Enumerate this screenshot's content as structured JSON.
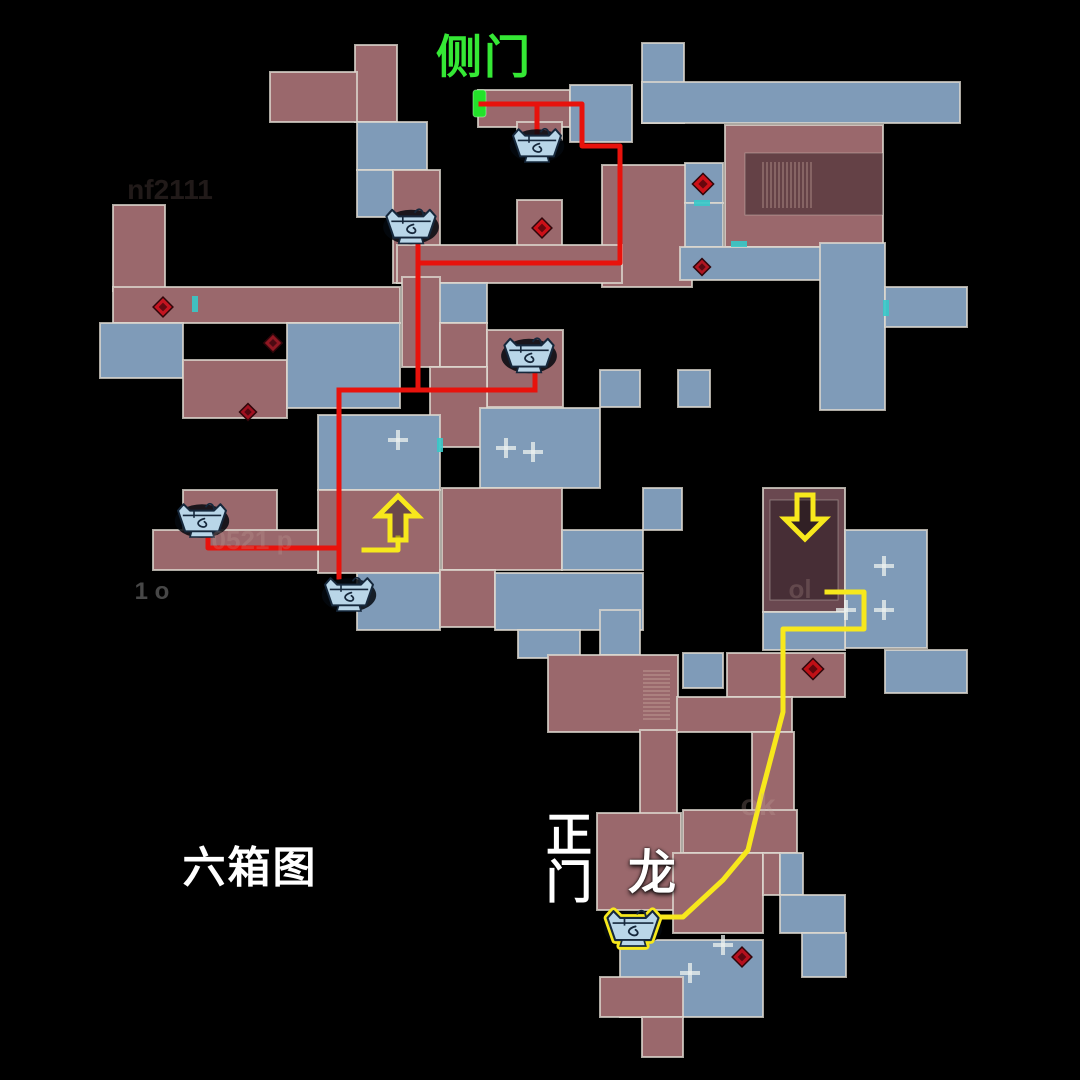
{
  "map": {
    "width": 1080,
    "height": 1080,
    "background": "#000000",
    "palette": {
      "red_room": "#9a686c",
      "blue_room": "#7f9bb8",
      "dark_red_room": "#6a4850",
      "inner_shade": "rgba(20,8,14,0.40)",
      "wall": "rgba(222,217,207,0.78)",
      "route_red": "#e8120c",
      "route_yellow": "#f7e81c",
      "marker_green": "#23e22a",
      "teal_door": "#37c9c9",
      "chest_body": "#b9d6e8",
      "chest_line": "#16283c",
      "chest_shadow": "rgba(4,8,14,0.85)",
      "stair_line": "rgba(222,194,178,0.55)",
      "plus_mark": "rgba(236,241,239,0.75)"
    },
    "labels": {
      "side_door": {
        "text": "侧门",
        "x": 484,
        "y": 57,
        "color": "#35e835",
        "size": 46
      },
      "six_box_map": {
        "text": "六箱图",
        "x": 250,
        "y": 869,
        "color": "#ffffff",
        "size": 43
      },
      "main_gate_top": {
        "text": "正",
        "x": 570,
        "y": 835,
        "color": "#ffffff",
        "size": 46
      },
      "main_gate_bottom": {
        "text": "门",
        "x": 570,
        "y": 882,
        "color": "#ffffff",
        "size": 46
      },
      "dragon": {
        "text": "龙",
        "x": 653,
        "y": 874,
        "color": "#ffffff",
        "size": 48
      }
    },
    "faint_texts": [
      {
        "text": "nf2111",
        "x": 170,
        "y": 190,
        "size": 28,
        "color": "#caa49c",
        "opacity": 0.16
      },
      {
        "text": "0521 p",
        "x": 252,
        "y": 540,
        "size": 26,
        "color": "#c8a8a0",
        "opacity": 0.22
      },
      {
        "text": "ok",
        "x": 758,
        "y": 806,
        "size": 30,
        "color": "#c8a8a0",
        "opacity": 0.25
      },
      {
        "text": "ol",
        "x": 800,
        "y": 589,
        "size": 26,
        "color": "#c8a8a0",
        "opacity": 0.22
      },
      {
        "text": "1 o",
        "x": 152,
        "y": 592,
        "size": 24,
        "color": "#cccccc",
        "opacity": 0.35
      }
    ],
    "rooms": [
      {
        "x": 355,
        "y": 45,
        "w": 42,
        "h": 77,
        "c": "r"
      },
      {
        "x": 270,
        "y": 72,
        "w": 87,
        "h": 50,
        "c": "r"
      },
      {
        "x": 357,
        "y": 122,
        "w": 70,
        "h": 48,
        "c": "b"
      },
      {
        "x": 357,
        "y": 170,
        "w": 36,
        "h": 47,
        "c": "b"
      },
      {
        "x": 393,
        "y": 170,
        "w": 47,
        "h": 113,
        "c": "r"
      },
      {
        "x": 478,
        "y": 90,
        "w": 92,
        "h": 37,
        "c": "r"
      },
      {
        "x": 570,
        "y": 85,
        "w": 62,
        "h": 57,
        "c": "b"
      },
      {
        "x": 517,
        "y": 122,
        "w": 45,
        "h": 18,
        "c": "r"
      },
      {
        "x": 517,
        "y": 200,
        "w": 45,
        "h": 50,
        "c": "r"
      },
      {
        "x": 602,
        "y": 165,
        "w": 90,
        "h": 122,
        "c": "r"
      },
      {
        "x": 642,
        "y": 43,
        "w": 42,
        "h": 80,
        "c": "b"
      },
      {
        "x": 642,
        "y": 82,
        "w": 318,
        "h": 41,
        "c": "b"
      },
      {
        "x": 725,
        "y": 125,
        "w": 158,
        "h": 122,
        "c": "r"
      },
      {
        "x": 745,
        "y": 153,
        "w": 138,
        "h": 62,
        "c": "i"
      },
      {
        "x": 685,
        "y": 163,
        "w": 38,
        "h": 40,
        "c": "b"
      },
      {
        "x": 685,
        "y": 203,
        "w": 38,
        "h": 44,
        "c": "b"
      },
      {
        "x": 680,
        "y": 247,
        "w": 203,
        "h": 33,
        "c": "b"
      },
      {
        "x": 820,
        "y": 243,
        "w": 65,
        "h": 167,
        "c": "b"
      },
      {
        "x": 885,
        "y": 287,
        "w": 82,
        "h": 40,
        "c": "b"
      },
      {
        "x": 397,
        "y": 245,
        "w": 225,
        "h": 38,
        "c": "r"
      },
      {
        "x": 430,
        "y": 283,
        "w": 57,
        "h": 40,
        "c": "b"
      },
      {
        "x": 402,
        "y": 277,
        "w": 38,
        "h": 90,
        "c": "r"
      },
      {
        "x": 440,
        "y": 323,
        "w": 47,
        "h": 44,
        "c": "r"
      },
      {
        "x": 487,
        "y": 330,
        "w": 76,
        "h": 77,
        "c": "r"
      },
      {
        "x": 430,
        "y": 367,
        "w": 57,
        "h": 80,
        "c": "r"
      },
      {
        "x": 480,
        "y": 408,
        "w": 120,
        "h": 80,
        "c": "b"
      },
      {
        "x": 600,
        "y": 370,
        "w": 40,
        "h": 37,
        "c": "b"
      },
      {
        "x": 678,
        "y": 370,
        "w": 32,
        "h": 37,
        "c": "b"
      },
      {
        "x": 318,
        "y": 415,
        "w": 122,
        "h": 75,
        "c": "b"
      },
      {
        "x": 113,
        "y": 205,
        "w": 52,
        "h": 86,
        "c": "r"
      },
      {
        "x": 113,
        "y": 287,
        "w": 287,
        "h": 36,
        "c": "r"
      },
      {
        "x": 100,
        "y": 323,
        "w": 83,
        "h": 55,
        "c": "b"
      },
      {
        "x": 183,
        "y": 360,
        "w": 104,
        "h": 58,
        "c": "r"
      },
      {
        "x": 287,
        "y": 323,
        "w": 113,
        "h": 85,
        "c": "b"
      },
      {
        "x": 318,
        "y": 490,
        "w": 122,
        "h": 83,
        "c": "r"
      },
      {
        "x": 183,
        "y": 490,
        "w": 94,
        "h": 47,
        "c": "r"
      },
      {
        "x": 153,
        "y": 530,
        "w": 165,
        "h": 40,
        "c": "r"
      },
      {
        "x": 357,
        "y": 573,
        "w": 83,
        "h": 57,
        "c": "b"
      },
      {
        "x": 442,
        "y": 488,
        "w": 120,
        "h": 82,
        "c": "r"
      },
      {
        "x": 440,
        "y": 570,
        "w": 55,
        "h": 57,
        "c": "r"
      },
      {
        "x": 562,
        "y": 530,
        "w": 81,
        "h": 40,
        "c": "b"
      },
      {
        "x": 643,
        "y": 488,
        "w": 39,
        "h": 42,
        "c": "b"
      },
      {
        "x": 495,
        "y": 573,
        "w": 148,
        "h": 57,
        "c": "b"
      },
      {
        "x": 518,
        "y": 630,
        "w": 62,
        "h": 28,
        "c": "b"
      },
      {
        "x": 763,
        "y": 488,
        "w": 82,
        "h": 124,
        "c": "d"
      },
      {
        "x": 770,
        "y": 500,
        "w": 68,
        "h": 100,
        "c": "i"
      },
      {
        "x": 845,
        "y": 530,
        "w": 82,
        "h": 118,
        "c": "b"
      },
      {
        "x": 763,
        "y": 612,
        "w": 82,
        "h": 38,
        "c": "b"
      },
      {
        "x": 885,
        "y": 650,
        "w": 82,
        "h": 43,
        "c": "b"
      },
      {
        "x": 600,
        "y": 610,
        "w": 40,
        "h": 45,
        "c": "b"
      },
      {
        "x": 548,
        "y": 655,
        "w": 130,
        "h": 77,
        "c": "r"
      },
      {
        "x": 683,
        "y": 653,
        "w": 40,
        "h": 35,
        "c": "b"
      },
      {
        "x": 727,
        "y": 653,
        "w": 118,
        "h": 44,
        "c": "r"
      },
      {
        "x": 640,
        "y": 730,
        "w": 37,
        "h": 85,
        "c": "r"
      },
      {
        "x": 677,
        "y": 697,
        "w": 115,
        "h": 35,
        "c": "r"
      },
      {
        "x": 752,
        "y": 732,
        "w": 42,
        "h": 81,
        "c": "r"
      },
      {
        "x": 597,
        "y": 813,
        "w": 84,
        "h": 97,
        "c": "r"
      },
      {
        "x": 683,
        "y": 810,
        "w": 114,
        "h": 43,
        "c": "r"
      },
      {
        "x": 673,
        "y": 853,
        "w": 90,
        "h": 80,
        "c": "r"
      },
      {
        "x": 763,
        "y": 853,
        "w": 17,
        "h": 42,
        "c": "r"
      },
      {
        "x": 780,
        "y": 853,
        "w": 23,
        "h": 42,
        "c": "b"
      },
      {
        "x": 780,
        "y": 895,
        "w": 65,
        "h": 38,
        "c": "b"
      },
      {
        "x": 802,
        "y": 933,
        "w": 44,
        "h": 44,
        "c": "b"
      },
      {
        "x": 620,
        "y": 940,
        "w": 143,
        "h": 77,
        "c": "b"
      },
      {
        "x": 600,
        "y": 977,
        "w": 83,
        "h": 40,
        "c": "r"
      },
      {
        "x": 642,
        "y": 1017,
        "w": 41,
        "h": 40,
        "c": "r"
      }
    ],
    "stairs": [
      {
        "x": 763,
        "y": 162,
        "w": 50,
        "h": 46,
        "dir": "v",
        "step": 4
      },
      {
        "x": 643,
        "y": 671,
        "w": 27,
        "h": 48,
        "dir": "h",
        "step": 4
      }
    ],
    "plus_marks": [
      [
        506,
        448
      ],
      [
        533,
        452
      ],
      [
        846,
        610
      ],
      [
        884,
        610
      ],
      [
        884,
        566
      ],
      [
        690,
        973
      ],
      [
        723,
        945
      ],
      [
        398,
        440
      ]
    ],
    "teal_doors": [
      {
        "x": 192,
        "y": 296,
        "w": 6,
        "h": 16
      },
      {
        "x": 694,
        "y": 200,
        "w": 16,
        "h": 6
      },
      {
        "x": 731,
        "y": 241,
        "w": 16,
        "h": 6
      },
      {
        "x": 883,
        "y": 300,
        "w": 6,
        "h": 16
      },
      {
        "x": 437,
        "y": 438,
        "w": 6,
        "h": 14
      }
    ],
    "diamonds": [
      {
        "x": 163,
        "y": 307,
        "s": 14,
        "fill": "#c41420"
      },
      {
        "x": 273,
        "y": 343,
        "s": 13,
        "fill": "#8f1722"
      },
      {
        "x": 248,
        "y": 412,
        "s": 12,
        "fill": "#a01020"
      },
      {
        "x": 542,
        "y": 228,
        "s": 14,
        "fill": "#cc1018"
      },
      {
        "x": 703,
        "y": 184,
        "s": 15,
        "fill": "#cc1018"
      },
      {
        "x": 702,
        "y": 267,
        "s": 12,
        "fill": "#b01622"
      },
      {
        "x": 813,
        "y": 669,
        "s": 15,
        "fill": "#c01016"
      },
      {
        "x": 742,
        "y": 957,
        "s": 14,
        "fill": "#b5101e"
      }
    ],
    "chests": [
      {
        "x": 537,
        "y": 146,
        "scale": 0.8,
        "highlight": false
      },
      {
        "x": 411,
        "y": 227,
        "scale": 0.82,
        "highlight": false
      },
      {
        "x": 529,
        "y": 356,
        "scale": 0.82,
        "highlight": false
      },
      {
        "x": 202,
        "y": 521,
        "scale": 0.8,
        "highlight": false
      },
      {
        "x": 349,
        "y": 595,
        "scale": 0.8,
        "highlight": false
      },
      {
        "x": 633,
        "y": 929,
        "scale": 0.85,
        "highlight": true
      }
    ],
    "arrows": [
      {
        "x": 398,
        "y": 518,
        "dir": "up"
      },
      {
        "x": 805,
        "y": 517,
        "dir": "down"
      }
    ],
    "green_door": {
      "x": 473,
      "y": 90,
      "w": 13,
      "h": 27
    },
    "red_routes": [
      [
        [
          481,
          104
        ],
        [
          582,
          104
        ],
        [
          582,
          146
        ],
        [
          620,
          146
        ],
        [
          620,
          263
        ],
        [
          418,
          263
        ]
      ],
      [
        [
          537,
          104
        ],
        [
          537,
          132
        ]
      ],
      [
        [
          418,
          242
        ],
        [
          418,
          390
        ]
      ],
      [
        [
          339,
          390
        ],
        [
          535,
          390
        ]
      ],
      [
        [
          535,
          390
        ],
        [
          535,
          374
        ]
      ],
      [
        [
          339,
          390
        ],
        [
          339,
          577
        ]
      ],
      [
        [
          208,
          536
        ],
        [
          208,
          548
        ],
        [
          339,
          548
        ]
      ]
    ],
    "yellow_routes": [
      [
        [
          827,
          592
        ],
        [
          864,
          592
        ],
        [
          864,
          629
        ],
        [
          783,
          629
        ],
        [
          783,
          712
        ],
        [
          762,
          792
        ],
        [
          748,
          850
        ],
        [
          723,
          880
        ],
        [
          683,
          917
        ],
        [
          658,
          917
        ]
      ],
      [
        [
          398,
          538
        ],
        [
          398,
          550
        ],
        [
          364,
          550
        ]
      ]
    ]
  }
}
